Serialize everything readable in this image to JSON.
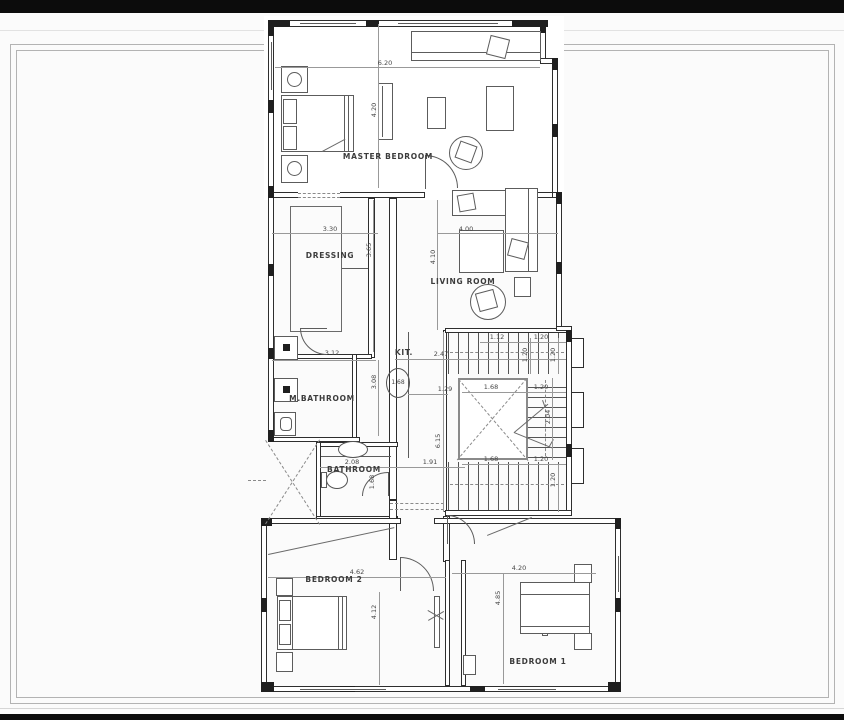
{
  "drawing": {
    "type": "architectural floor plan",
    "ink_color": "#2e2e2e",
    "sheet_color": "#ffffff"
  },
  "rooms": {
    "master_bedroom": {
      "label": "MASTER BEDROOM",
      "width": "6.20",
      "depth": "4.20"
    },
    "dressing": {
      "label": "DRESSING",
      "width": "3.30",
      "depth": "3.65"
    },
    "living_room": {
      "label": "LIVING ROOM",
      "width": "4.00",
      "depth": "4.10"
    },
    "m_bathroom": {
      "label": "M.BATHROOM",
      "width": "3.12",
      "depth": "3.08"
    },
    "kitchen": {
      "label": "KIT.",
      "circled": "1.68",
      "width": "1.29",
      "to_stairs": "2.47",
      "corridor": "1.91",
      "length": "6.15"
    },
    "bathroom": {
      "label": "BATHROOM",
      "width": "2.08",
      "door": "1.68"
    },
    "bedroom_2": {
      "label": "BEDROOM 2",
      "width": "4.62",
      "depth": "4.12"
    },
    "bedroom_1": {
      "label": "BEDROOM 1",
      "width": "4.20",
      "depth": "4.85"
    }
  },
  "stairs": {
    "top_run": "1.12",
    "top_right": "1.20",
    "riser_left": "1.20",
    "riser_right": "1.20",
    "void_top": "1.68",
    "mid_right": "1.20",
    "mid_height": "2.04",
    "void_bottom": "1.68",
    "bottom_right": "1.20",
    "bottom_riser": "1.20"
  }
}
